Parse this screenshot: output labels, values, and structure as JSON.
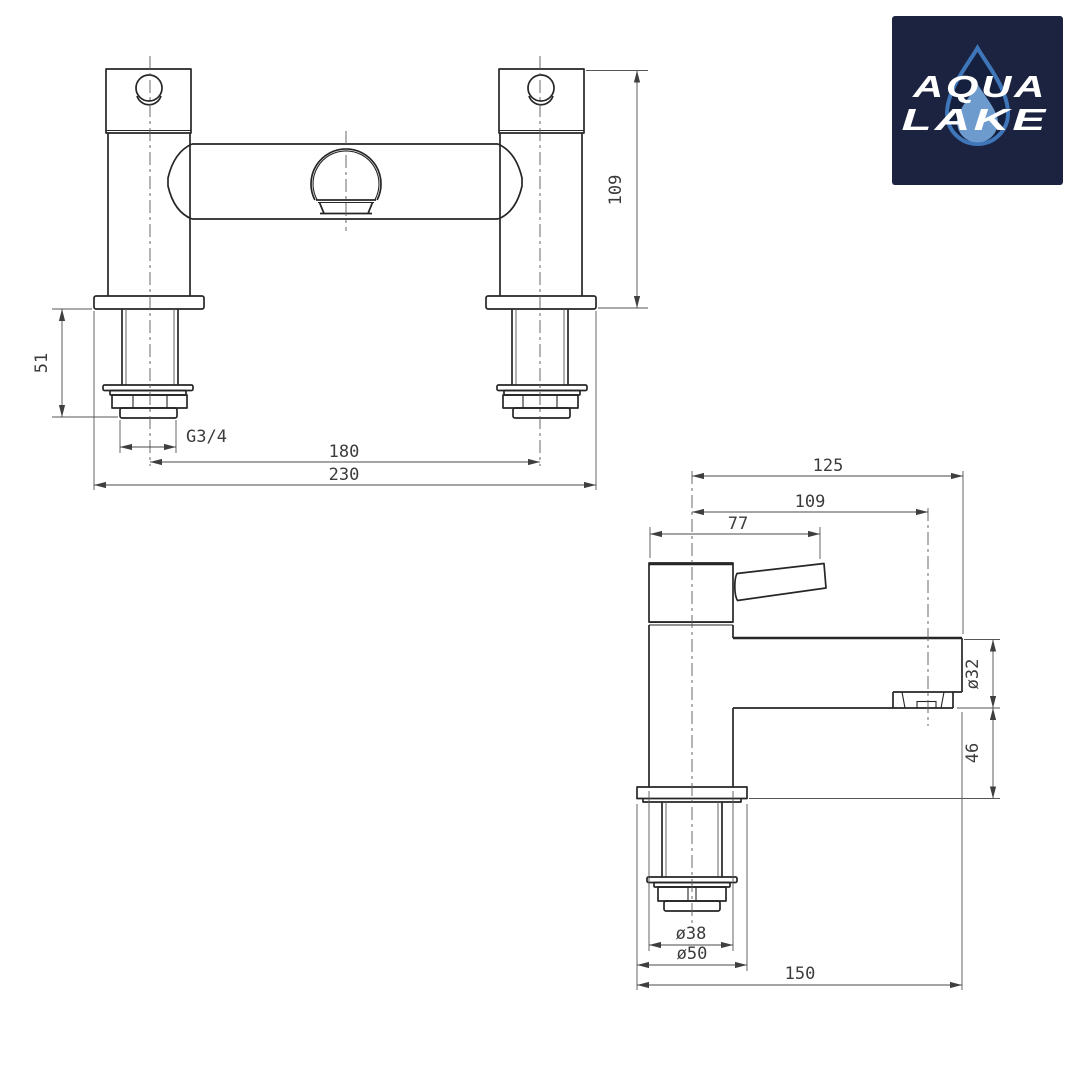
{
  "logo": {
    "line1": "AQUA",
    "line2": "LAKE",
    "background": "#1b2340",
    "drop_outline": "#3e76b9",
    "drop_fill": "#15203f",
    "drop_inner": "#6d9bcd",
    "text_color": "#ffffff"
  },
  "front_view": {
    "dims": {
      "height": "109",
      "under_deck": "51",
      "thread": "G3/4",
      "hole_centres": "180",
      "overall_width": "230"
    }
  },
  "side_view": {
    "dims": {
      "projection": "125",
      "aerator_reach": "109",
      "handle_reach": "77",
      "spout_dia": "ø32",
      "spout_clearance": "46",
      "body_dia": "ø38",
      "flange_dia": "ø50",
      "depth": "150"
    }
  },
  "drawing": {
    "outline_color": "#262626",
    "thin_line_color": "#565656",
    "dim_text_color": "#3c3c3c",
    "background": "#ffffff"
  }
}
